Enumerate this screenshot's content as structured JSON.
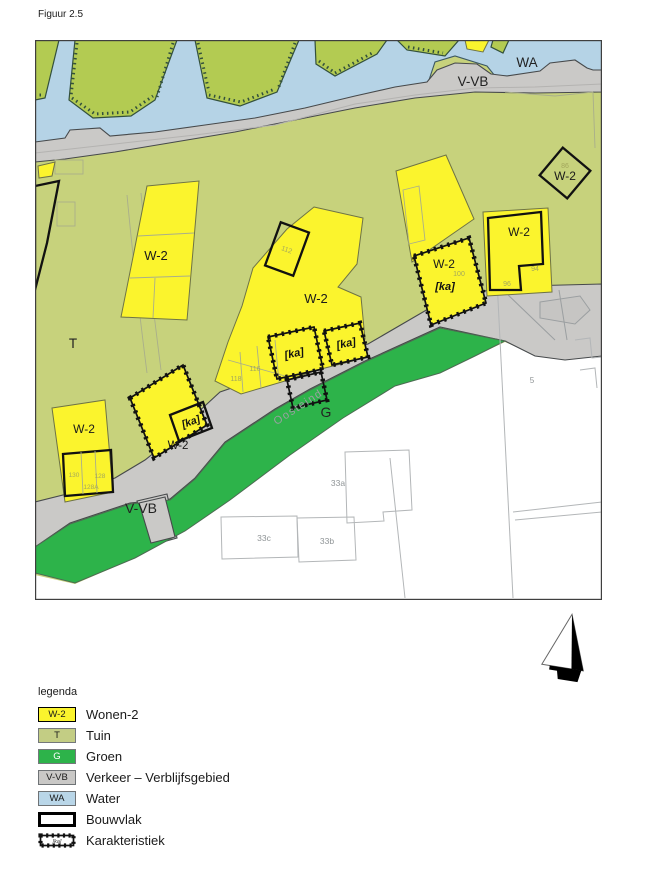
{
  "figure": {
    "title": "Figuur 2.5"
  },
  "map": {
    "water_label": "WA",
    "road_label_top": "V-VB",
    "road_label_bottom": "V-VB",
    "garden_label": "T",
    "green_label": "G",
    "street_name": "Oosteind",
    "w2": "W-2",
    "ka": "[ka]",
    "house_numbers": {
      "n112": "112",
      "n118": "118",
      "n116": "116",
      "n100": "100",
      "n94": "94",
      "n96": "96",
      "n86": "86",
      "n130": "130",
      "n128": "128",
      "n128a": "128A",
      "n33a": "33a",
      "n33b": "33b",
      "n33c": "33c",
      "n5": "5"
    }
  },
  "legend": {
    "title": "legenda",
    "items": [
      {
        "code": "W-2",
        "label": "Wonen-2"
      },
      {
        "code": "T",
        "label": "Tuin"
      },
      {
        "code": "G",
        "label": "Groen"
      },
      {
        "code": "V-VB",
        "label": "Verkeer – Verblijfsgebied"
      },
      {
        "code": "WA",
        "label": "Water"
      },
      {
        "code": "",
        "label": "Bouwvlak"
      },
      {
        "code": "[ka]",
        "label": "Karakteristiek"
      }
    ]
  },
  "colors": {
    "wonen": "#fbf42d",
    "tuin": "#c7d27c",
    "tuin_top": "#b3cb52",
    "groen": "#2db34a",
    "verkeer": "#cac9c7",
    "water": "#b5d3e6",
    "outside": "#ffffff"
  }
}
